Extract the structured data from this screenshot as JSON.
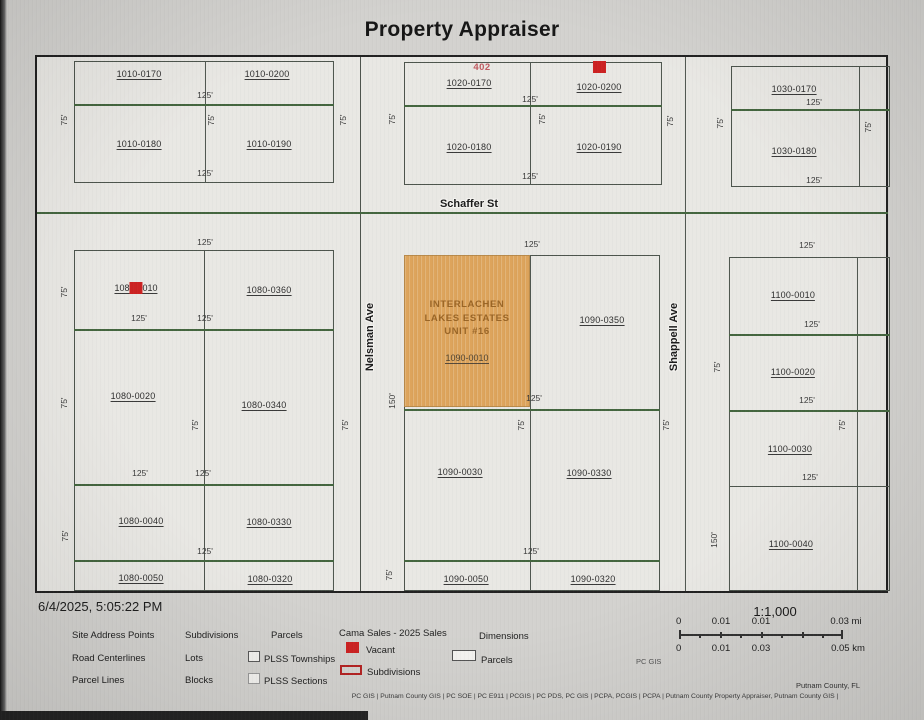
{
  "title": "Property Appraiser",
  "timestamp": "6/4/2025, 5:05:22 PM",
  "streets": {
    "schaffer": "Schaffer St",
    "nelsman": "Nelsman Ave",
    "shappell": "Shappell Ave"
  },
  "sale_marker": "402",
  "dims": {
    "d125": "125'",
    "d75": "75'",
    "d150": "150'"
  },
  "parcels": {
    "p1010_0170": "1010-0170",
    "p1010_0200": "1010-0200",
    "p1010_0180": "1010-0180",
    "p1010_0190": "1010-0190",
    "p1020_0170": "1020-0170",
    "p1020_0200": "1020-0200",
    "p1020_0180": "1020-0180",
    "p1020_0190": "1020-0190",
    "p1030_0170": "1030-0170",
    "p1030_0180": "1030-0180",
    "p1080_0010_a": "108",
    "p1080_0010_b": "010",
    "p1080_0360": "1080-0360",
    "p1080_0020": "1080-0020",
    "p1080_0340": "1080-0340",
    "p1080_0040": "1080-0040",
    "p1080_0330": "1080-0330",
    "p1080_0050": "1080-0050",
    "p1080_0320": "1080-0320",
    "p1090_0350": "1090-0350",
    "p1090_0030": "1090-0030",
    "p1090_0330": "1090-0330",
    "p1090_0050": "1090-0050",
    "p1090_0320": "1090-0320",
    "p1100_0010": "1100-0010",
    "p1100_0020": "1100-0020",
    "p1100_0030": "1100-0030",
    "p1100_0040": "1100-0040"
  },
  "highlight": {
    "line1": "INTERLACHEN",
    "line2": "LAKES ESTATES",
    "line3": "UNIT #16",
    "parcel_id": "1090-0010",
    "fill": "#dda45c"
  },
  "legend": {
    "site_address_points": "Site Address Points",
    "road_centerlines": "Road Centerlines",
    "parcel_lines": "Parcel Lines",
    "subdivisions": "Subdivisions",
    "lots": "Lots",
    "blocks": "Blocks",
    "parcels": "Parcels",
    "plss_townships": "PLSS Townships",
    "plss_sections": "PLSS Sections",
    "cama_header": "Cama Sales - 2025 Sales",
    "vacant": "Vacant",
    "cama_subdivisions": "Subdivisions",
    "dimensions": "Dimensions",
    "parcels2": "Parcels"
  },
  "scale": {
    "ratio": "1:1,000",
    "mi": [
      "0",
      "0.01",
      "0.01",
      "0.03 mi"
    ],
    "km": [
      "0",
      "0.01",
      "0.03",
      "0.05 km"
    ]
  },
  "footer": {
    "region": "Putnam County, FL",
    "gis_label": "PC GIS",
    "credits": "PC GIS | Putnam County GIS | PC SOE | PC E911 | PCGIS | PC PDS, PC GIS | PCPA, PCGIS | PCPA | Putnam County Property Appraiser, Putnam County GIS |"
  },
  "colors": {
    "vacant_red": "#cc2222",
    "highlight_orange": "#dda45c",
    "lot_line_green": "#44663f",
    "sale_text_red": "#c05a60"
  }
}
